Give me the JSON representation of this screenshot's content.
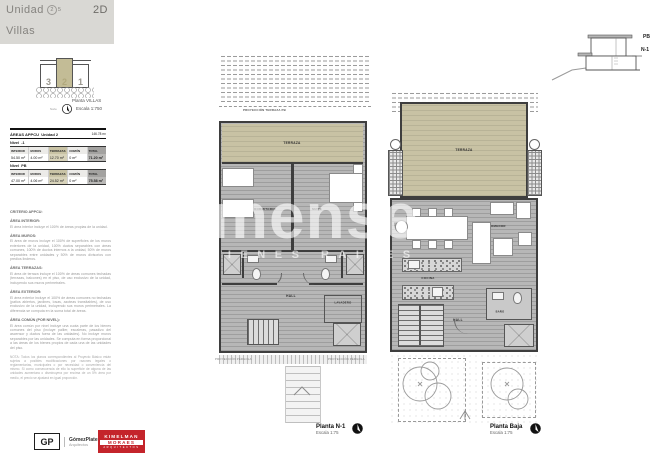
{
  "header": {
    "title": "Unidad",
    "num": "2",
    "of": "5",
    "right": "2D",
    "subtitle": "Villas"
  },
  "keyplan": {
    "n_left": "3",
    "n_mid": "2",
    "n_right": "1",
    "caption": "Planta VILLAS",
    "scale": "Escala 1:750",
    "north": "Norte"
  },
  "section_diagram": {
    "pb": "PB",
    "n1": "N-1"
  },
  "areas_table": {
    "title": "ÁREAS APPCU",
    "unit": "Unidad 2",
    "total": "146.78 m²",
    "levels": [
      {
        "label": "Nivel",
        "code": "-1",
        "cols": [
          "INTERIOR",
          "MUROS",
          "TERRAZAS",
          "COMÚN",
          "TOTAL"
        ],
        "vals": [
          "54.50 m²",
          "4.00 m²",
          "12.70 m²",
          "0 m²",
          "71.20 m²"
        ]
      },
      {
        "label": "Nivel",
        "code": "PB",
        "cols": [
          "INTERIOR",
          "MUROS",
          "TERRAZAS",
          "COMÚN",
          "TOTAL"
        ],
        "vals": [
          "47.00 m²",
          "4.06 m²",
          "24.52 m²",
          "0 m²",
          "75.58 m²"
        ]
      }
    ]
  },
  "criteria": {
    "heading": "CRITERIO APPCU:",
    "items": [
      {
        "h": "ÁREA INTERIOR:",
        "p": "El área interior incluye el 100% de áreas propias de la unidad."
      },
      {
        "h": "ÁREA MUROS:",
        "p": "El área de muros incluye el 100% de superficies de los muros exteriores de la unidad, 100% ductos separables con áreas comunes, 100% de ductos internos a la unidad, 50% de muros separables entre unidades y 50% de muros divisorios con predios linderos."
      },
      {
        "h": "ÁREA TERRAZAS:",
        "p": "El área de terraza incluye el 100% de áreas comunes techadas (terrazas, balcones) en el piso, de uso exclusivo de la unidad, incluyendo sus muros perimetrales."
      },
      {
        "h": "ÁREA EXTERIOR:",
        "p": "El área exterior incluye el 100% de áreas comunes no techadas (patios abiertos, jardines, losas, azoteas transitables), de uso exclusivo de la unidad, incluyendo sus muros perimetrales. La diferencia se computa en la suma total de áreas."
      },
      {
        "h": "ÁREA COMÚN (POR NIVEL):",
        "p": "El área común por nivel incluye una cuota parte de los bienes comunes del piso (incluye pallier, escaleras, pasadizo del ascensor y ductos fuera de las unidades). No incluye muros separables por las unidades. Se computa en forma proporcional a las áreas de los bienes propios de cada una de las unidades del piso."
      }
    ],
    "note": "NOTA: Todos los planos correspondientes al Proyecto Básico están sujetos a posibles modificaciones por razones legales o reglamentarias, municipales o por necesidad o conveniencia del mismo. Si como consecuencia de ello la superficie de alguna de las unidades aumentara o disminuyera por encima de un 5% área por medio, el precio se ajustará en igual proporción."
  },
  "plans": {
    "n1": {
      "caption": "Planta N-1",
      "scale": "Escala 1:75",
      "proj_top": "PROYECCIÓN TERRAZA PB",
      "terraza": "TERRAZA",
      "dorm": "DORMITORIO",
      "suite": "SUITE",
      "hall": "HALL",
      "lav": "LAVADERO",
      "proj_left": "PROYECCIÓN PÉRGOLA",
      "proj_right": "PROYECCIÓN PÉRGOLA"
    },
    "pb": {
      "caption": "Planta Baja",
      "scale": "Escala 1:75",
      "terraza": "TERRAZA",
      "estar": "ESTAR / COMEDOR",
      "cocina": "COCINA",
      "hall": "HALL",
      "bano": "BAÑO"
    }
  },
  "watermark": {
    "main": "mense",
    "sub": "BIENES RAICES"
  },
  "footer": {
    "gp_initials": "GP",
    "gp_name": "GómezPlatero",
    "gp_sub": "Arquitectos",
    "km_line1": "KIMELMAN",
    "km_line2": "MORAES",
    "km_line3": "ARQUITECTOS"
  },
  "colors": {
    "accent_red": "#c4242b",
    "terrace_beige": "#c8c2a4",
    "header_gray": "#d9d8d4",
    "wall": "#3e3e3e"
  }
}
